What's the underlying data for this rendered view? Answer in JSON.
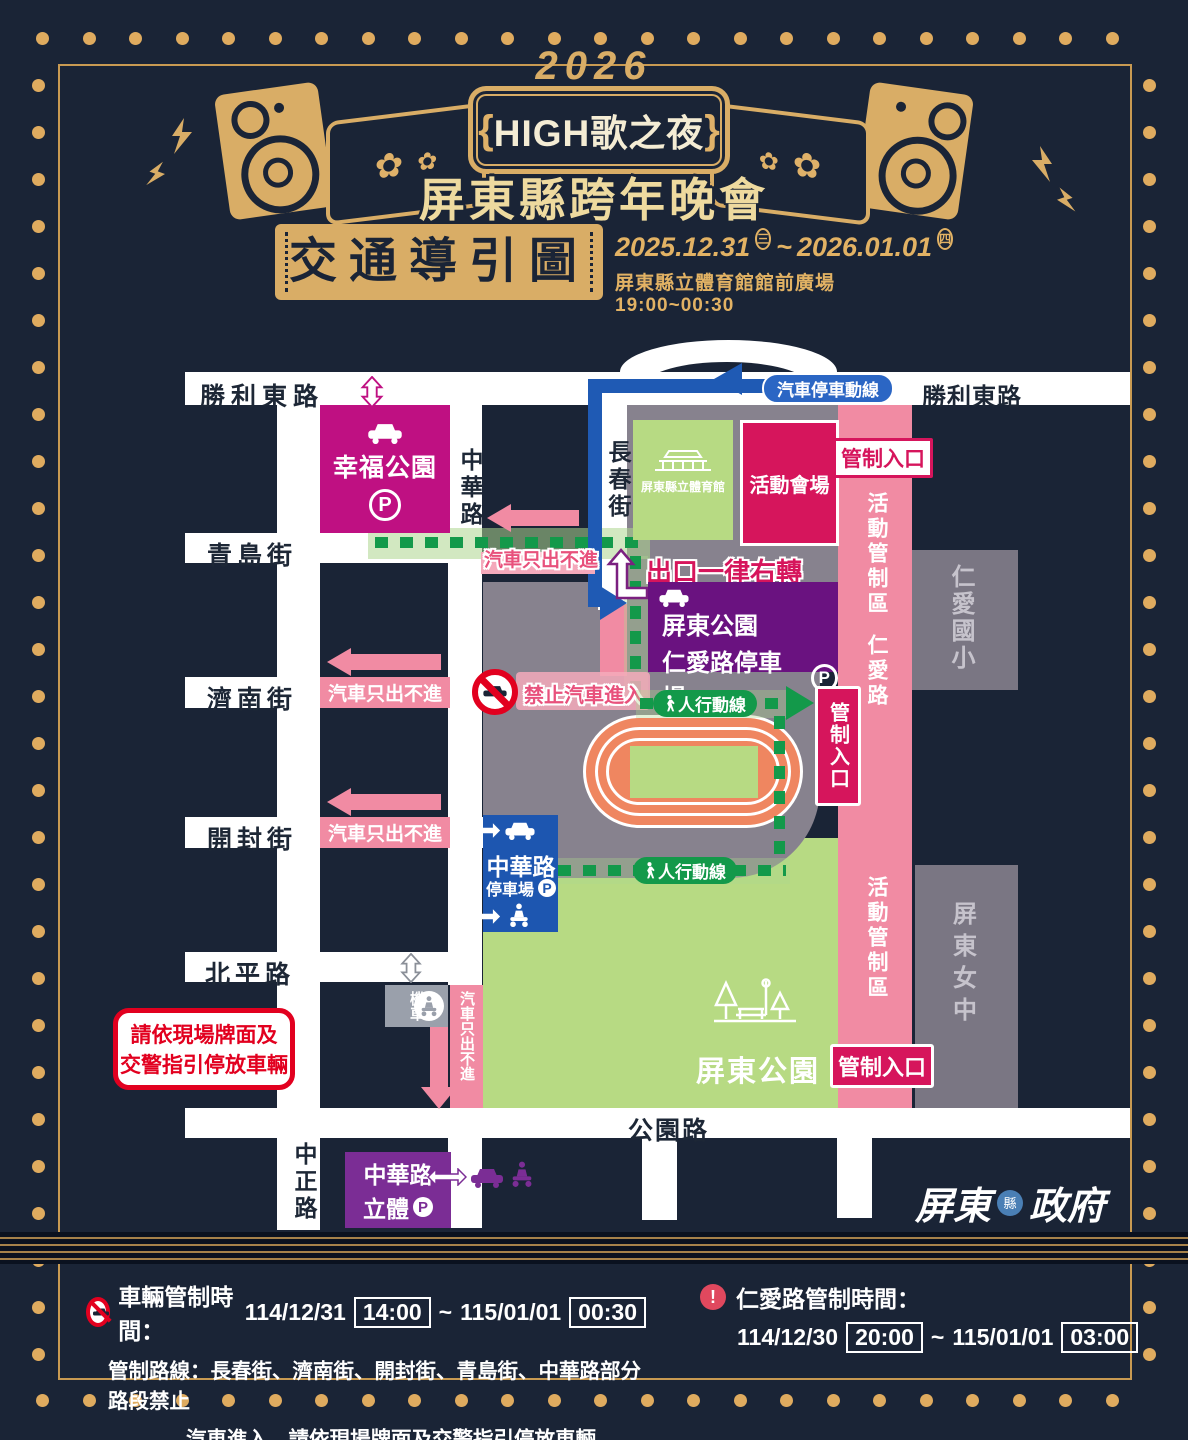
{
  "header": {
    "year": "2026",
    "sign_brace_left": "{",
    "sign_title": "HIGH歌之夜",
    "sign_brace_right": "}",
    "subtitle": "屏東縣跨年晚會",
    "rose_icon": "✿"
  },
  "title_bar": {
    "title": "交通導引圖",
    "date_start": "2025.12.31",
    "date_start_day": "三",
    "tilde": "~",
    "date_end": "2026.01.01",
    "date_end_day": "四",
    "venue_line": "屏東縣立體育館館前廣場 19:00~00:30"
  },
  "map": {
    "roads": {
      "shengli_left": "勝利東路",
      "shengli_right": "勝利東路",
      "qingdao": "青島街",
      "jinan": "濟南街",
      "kaifeng": "開封街",
      "beiping": "北平路",
      "gongyuan": "公園路",
      "zhonghua": "中華路",
      "changchun": "長春街",
      "zhongzheng": "中正路"
    },
    "zones": {
      "xingfu_park_name": "幸福公園",
      "xingfu_parking_p": "P",
      "stadium_name": "屏東縣立體育館",
      "venue_name": "活動會場",
      "renai_parking_line1": "屏東公園",
      "renai_parking_line2": "仁愛路停車場",
      "renai_parking_p": "P",
      "renai_school": "仁愛國小",
      "pingtung_girls": "屏東女中",
      "pingtung_park": "屏東公園",
      "zhonghua_parking_line1": "中華路",
      "zhonghua_parking_line2": "停車場",
      "zhonghua_parking_p": "P",
      "zhonghua_tower_line1": "中華路",
      "zhonghua_tower_line2": "立體",
      "zhonghua_tower_p": "P",
      "moto": "機車"
    },
    "strips": {
      "control_zone": "活動管制區",
      "renai_road": "仁愛路"
    },
    "labels": {
      "car_flow": "汽車停車動線",
      "control_entrance": "管制入口",
      "exit_right_turn": "出口一律右轉",
      "car_exit_only": "汽車只出不進",
      "no_car_entry": "禁止汽車進入",
      "pedestrian_flow": "人行動線",
      "warning_line1": "請依現場牌面及",
      "warning_line2": "交警指引停放車輛"
    }
  },
  "footer": {
    "left": {
      "title": "車輛管制時間：",
      "date1": "114/12/31",
      "time1": "14:00",
      "tilde": "~",
      "date2": "115/01/01",
      "time2": "00:30",
      "line2": "管制路線：長春街、濟南街、開封街、青島街、中華路部分路段禁止",
      "line3": "汽車進入，請依現場牌面及交警指引停放車輛"
    },
    "right": {
      "excl": "!",
      "title": "仁愛路管制時間：",
      "date1": "114/12/30",
      "time1": "20:00",
      "tilde": "~",
      "date2": "115/01/01",
      "time2": "03:00"
    },
    "logo_pre": "屏東",
    "logo_seal": "縣",
    "logo_post": "政府"
  },
  "colors": {
    "background_navy": "#1a2436",
    "gold": "#dfb169",
    "magenta_park": "#bf1082",
    "crimson_venue": "#d6155c",
    "light_green": "#b7da83",
    "purple_parking": "#6a1280",
    "purple_tower": "#7b2d95",
    "blue_route": "#1f5ab4",
    "pink_strip": "#f18ba3",
    "green_path": "#13994a",
    "gray_zone": "#87828e",
    "track_orange": "#ef8660",
    "warning_red": "#e2001f"
  }
}
